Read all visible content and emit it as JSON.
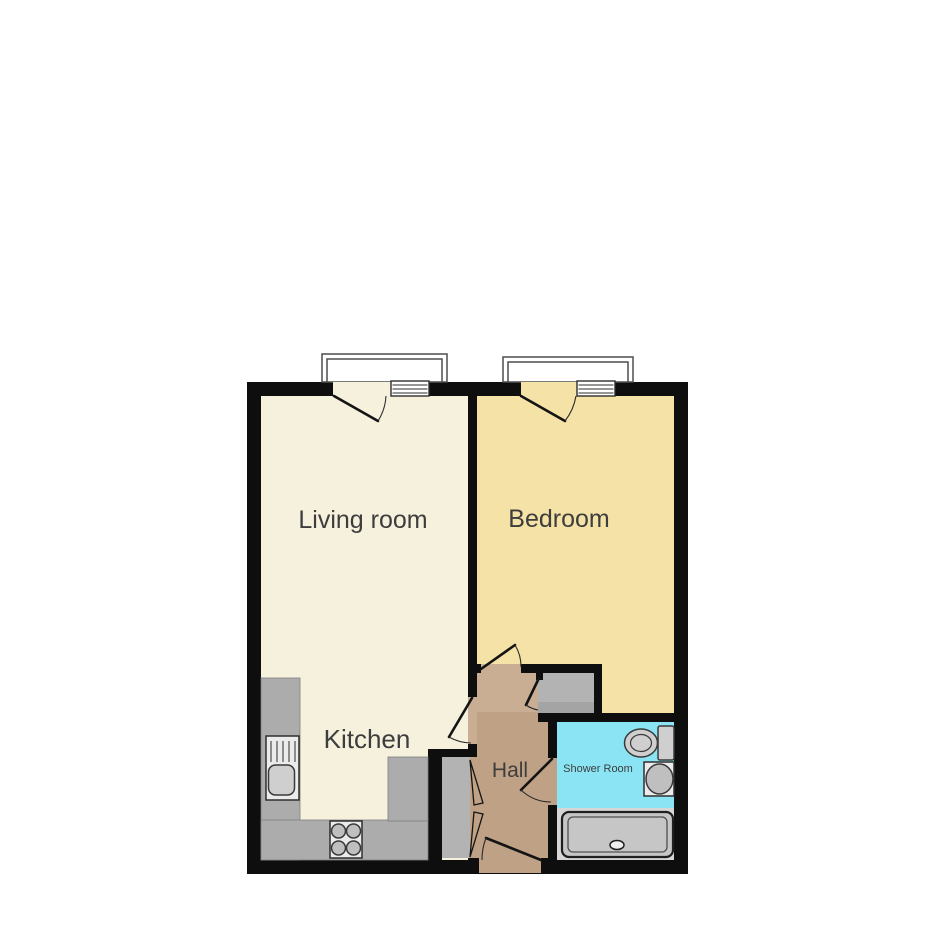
{
  "floorplan": {
    "type": "apartment-floor-plan",
    "rooms": [
      {
        "id": "living-room",
        "label": "Living room",
        "color": "#f6f1dd"
      },
      {
        "id": "bedroom",
        "label": "Bedroom",
        "color": "#f5e2a7"
      },
      {
        "id": "kitchen",
        "label": "Kitchen",
        "color": "#f6f1dd"
      },
      {
        "id": "hall",
        "label": "Hall",
        "color": "#bfa185"
      },
      {
        "id": "shower-room",
        "label": "Shower Room",
        "color": "#8be4f4"
      }
    ],
    "colors": {
      "background": "#ffffff",
      "wall": "#0e0e0e",
      "living": "#f6f1dd",
      "bedroom": "#f5e2a7",
      "hall": "#bfa185",
      "hall_light": "#c9ae94",
      "shower": "#8be4f4",
      "counter": "#acacac",
      "cupboard": "#b3b3b3",
      "tray_background": "#d6d6d6",
      "label_text": "#3d3d3d"
    },
    "fixtures": [
      "bay-window-living-room",
      "bay-window-bedroom",
      "kitchen-sink",
      "kitchen-hob",
      "toilet",
      "wash-basin",
      "shower-tray",
      "storage-cupboard",
      "airing-cupboard",
      "entrance-door"
    ]
  }
}
